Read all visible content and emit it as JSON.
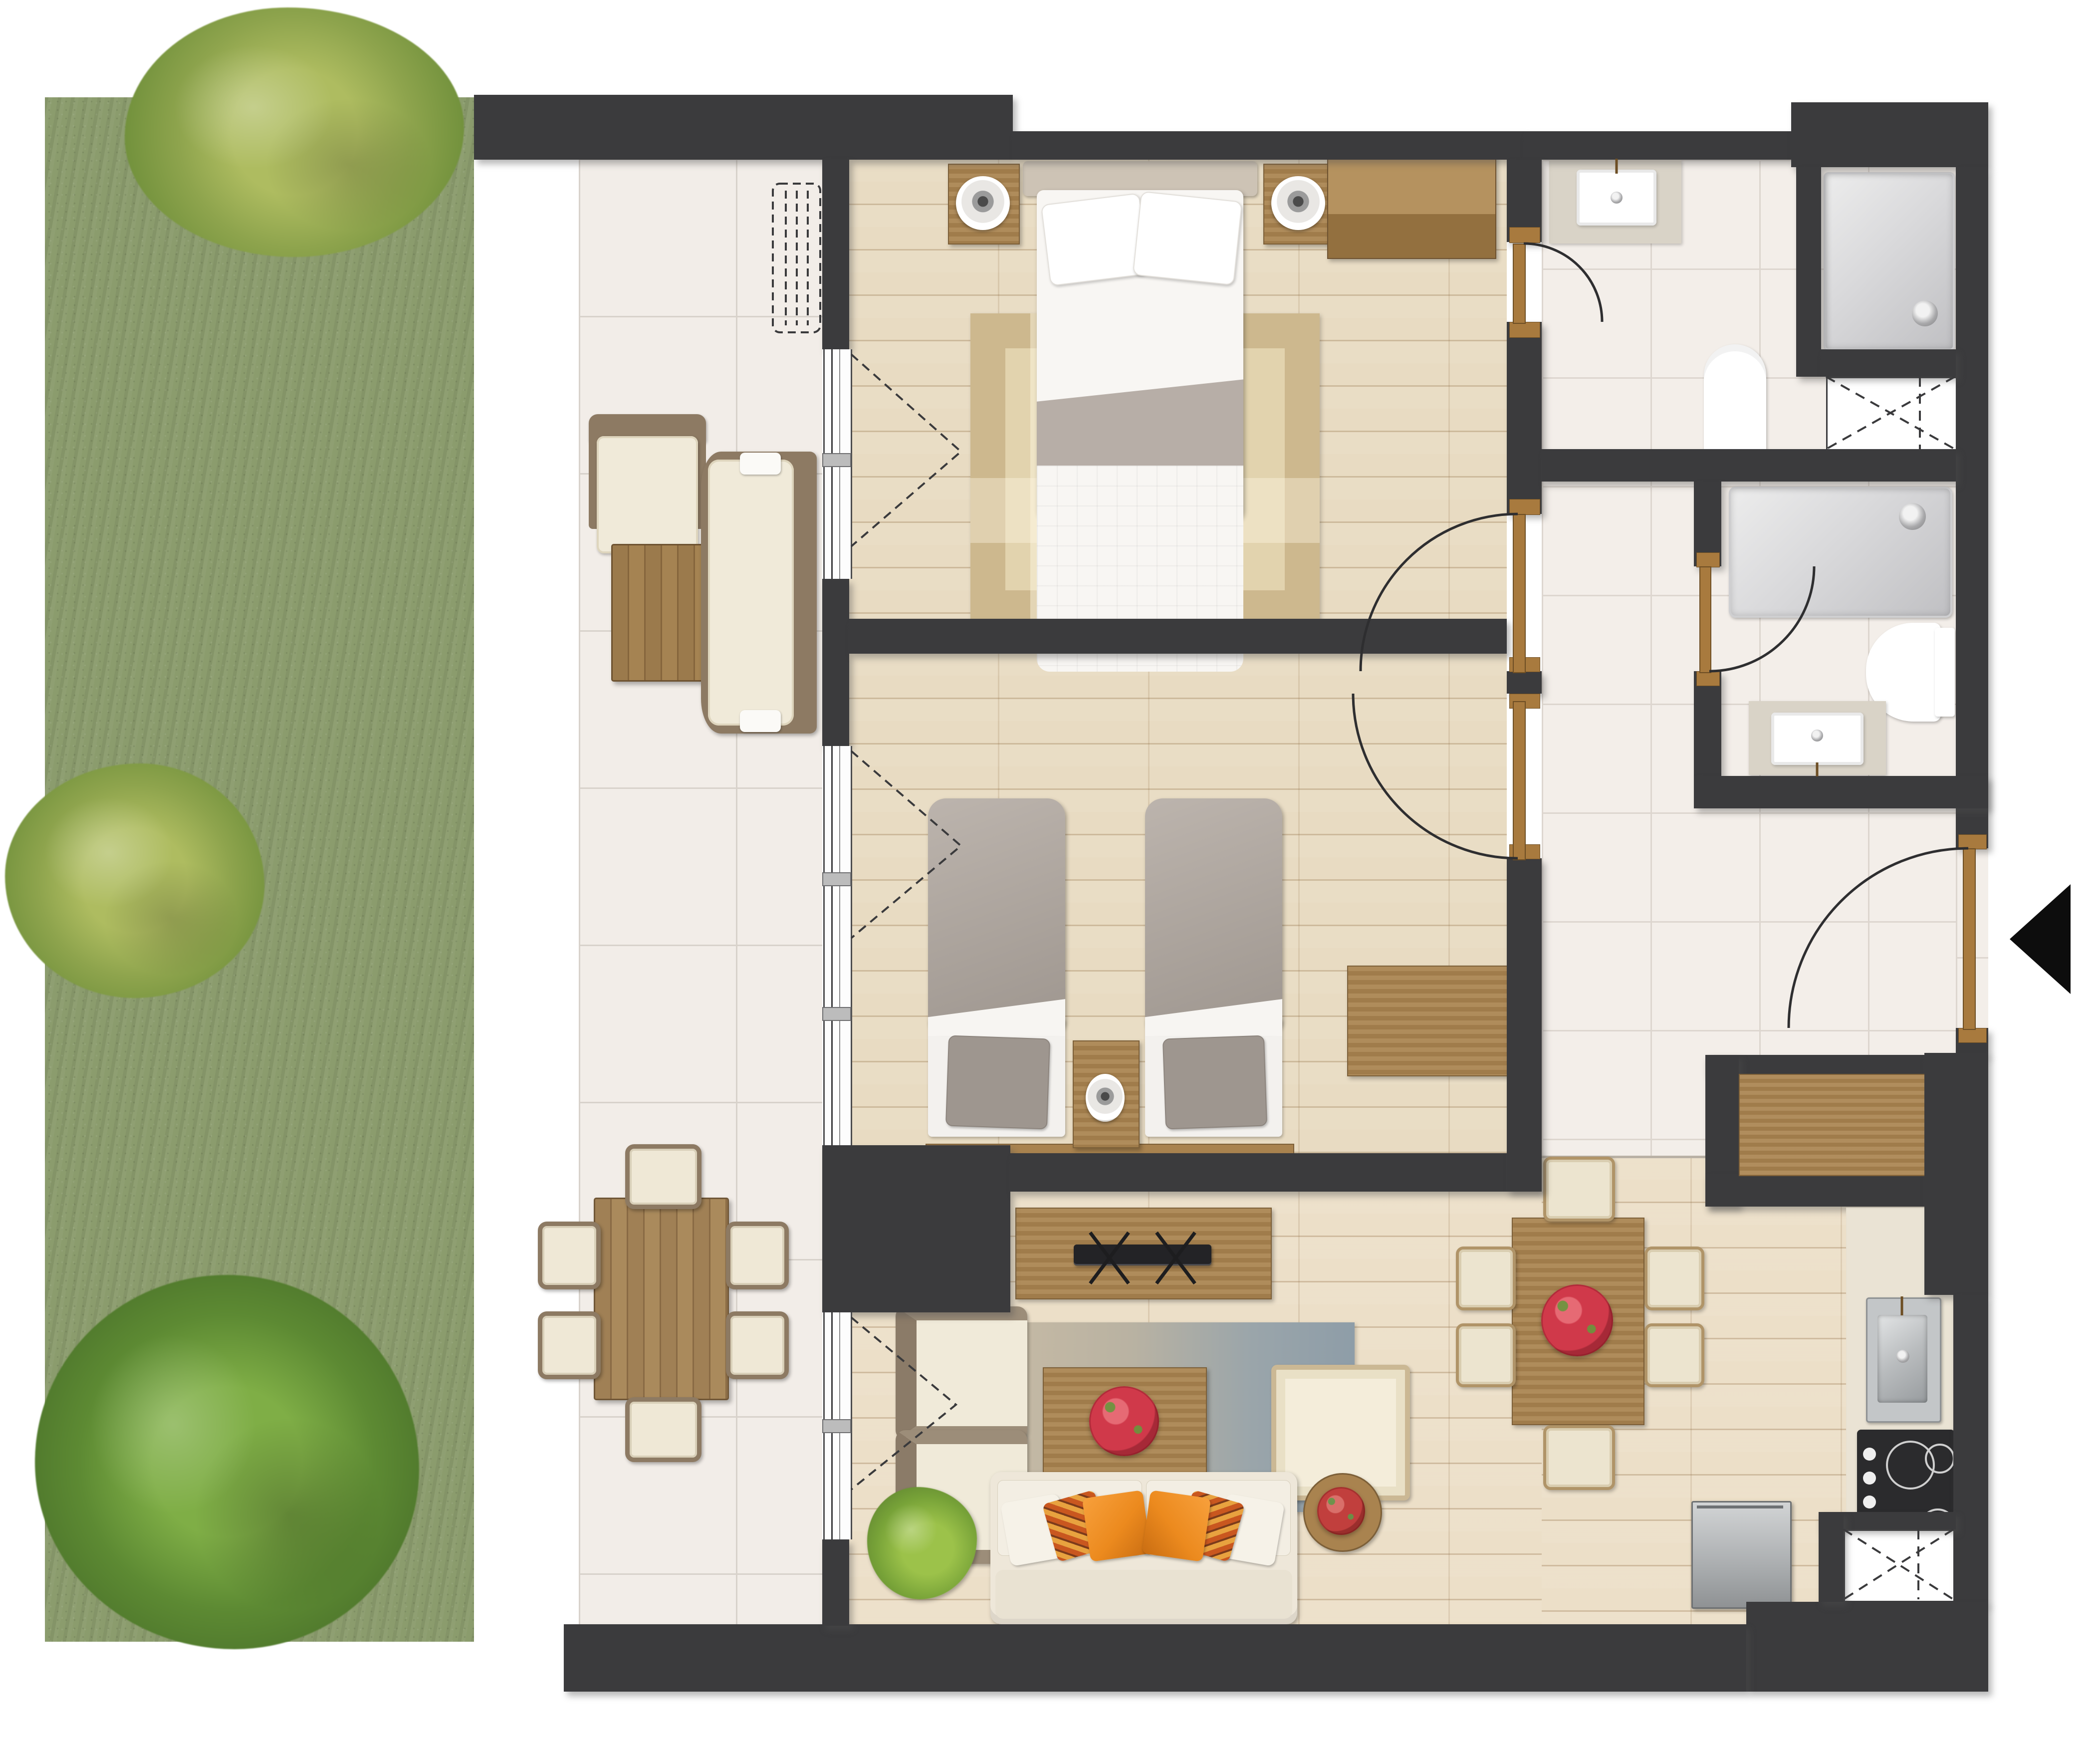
{
  "document": {
    "kind": "apartment floor plan",
    "view": "top-down color render",
    "text_labels_visible": []
  },
  "palette": {
    "background": "#ffffff",
    "wall": "#3b3b3d",
    "wood_floor": "#e8dbc2",
    "terrace_tile": "#f2ede8",
    "bathroom_tile": "#f3eee9",
    "grass": "#8b9c6d",
    "bush_olive": "#8ea44d",
    "bush_dark": "#5d8a33",
    "furniture_wood": "#a9834f",
    "door_wood": "#a87a3e",
    "upholstery_cream": "#efe9dd",
    "bedding_white": "#f8f6f3",
    "bedding_gray": "#b0a8a1",
    "pillow_orange": "#ec8a1e",
    "flowers_red": "#d0394a",
    "fixture_white": "#ffffff",
    "appliance_steel": "#c3c6c8",
    "cooktop_black": "#2b2b2d",
    "rug_plaid_beige": "#dcc99f",
    "rug_living_gradient": [
      "#cbbda5",
      "#8e9da8"
    ]
  },
  "zones": [
    {
      "name": "garden",
      "floor": "grass",
      "items": [
        {
          "name": "bush",
          "count": 3
        }
      ]
    },
    {
      "name": "terrace",
      "floor": "large ceramic tile",
      "items": [
        {
          "name": "outdoor armchair",
          "count": 1
        },
        {
          "name": "outdoor coffee table",
          "count": 1
        },
        {
          "name": "outdoor sofa",
          "count": 1
        },
        {
          "name": "outdoor dining table",
          "count": 1
        },
        {
          "name": "outdoor dining chair",
          "count": 6
        },
        {
          "name": "radiator (dashed symbol)",
          "count": 1
        }
      ]
    },
    {
      "name": "master bedroom",
      "floor": "wood",
      "items": [
        {
          "name": "double bed",
          "count": 1
        },
        {
          "name": "bed pillow",
          "count": 2
        },
        {
          "name": "nightstand with lamp",
          "count": 2
        },
        {
          "name": "wardrobe",
          "count": 1
        },
        {
          "name": "plaid area rug",
          "count": 1
        }
      ]
    },
    {
      "name": "second bedroom",
      "floor": "wood",
      "items": [
        {
          "name": "single bed",
          "count": 2
        },
        {
          "name": "nightstand with lamp",
          "count": 1
        },
        {
          "name": "dresser",
          "count": 1
        }
      ]
    },
    {
      "name": "ensuite bathroom",
      "floor": "tile",
      "items": [
        {
          "name": "washbasin on counter",
          "count": 1
        },
        {
          "name": "toilet",
          "count": 1
        },
        {
          "name": "shower tray",
          "count": 1
        },
        {
          "name": "service shaft (dashed X)",
          "count": 1
        }
      ]
    },
    {
      "name": "second bathroom",
      "floor": "tile",
      "items": [
        {
          "name": "bathtub",
          "count": 1
        },
        {
          "name": "toilet",
          "count": 1
        },
        {
          "name": "washbasin on counter",
          "count": 1
        }
      ]
    },
    {
      "name": "hallway",
      "floor": "tile",
      "items": [
        {
          "name": "built-in closet",
          "count": 1
        },
        {
          "name": "entrance door",
          "count": 1
        },
        {
          "name": "entrance arrow marker",
          "count": 1
        }
      ]
    },
    {
      "name": "living dining room",
      "floor": "wood",
      "items": [
        {
          "name": "tv console",
          "count": 1
        },
        {
          "name": "tv",
          "count": 1
        },
        {
          "name": "armchair",
          "count": 2
        },
        {
          "name": "coffee table with flower bowl",
          "count": 1
        },
        {
          "name": "ottoman",
          "count": 1
        },
        {
          "name": "sofa",
          "count": 1
        },
        {
          "name": "sofa pillow",
          "count": 6
        },
        {
          "name": "round side table with flowers",
          "count": 1
        },
        {
          "name": "potted plant",
          "count": 1
        },
        {
          "name": "dining table with flower bowl",
          "count": 1
        },
        {
          "name": "dining chair",
          "count": 6
        },
        {
          "name": "gradient area rug",
          "count": 1
        }
      ]
    },
    {
      "name": "kitchen",
      "floor": "tile",
      "items": [
        {
          "name": "counter",
          "count": 1
        },
        {
          "name": "stainless sink",
          "count": 1
        },
        {
          "name": "cooktop burner",
          "count": 4
        },
        {
          "name": "cooktop knob",
          "count": 4
        },
        {
          "name": "appliance",
          "count": 1
        },
        {
          "name": "service shaft (dashed X)",
          "count": 1
        }
      ]
    }
  ],
  "openings": {
    "windows": 3,
    "interior_doors": 4,
    "entrance_doors": 1
  }
}
